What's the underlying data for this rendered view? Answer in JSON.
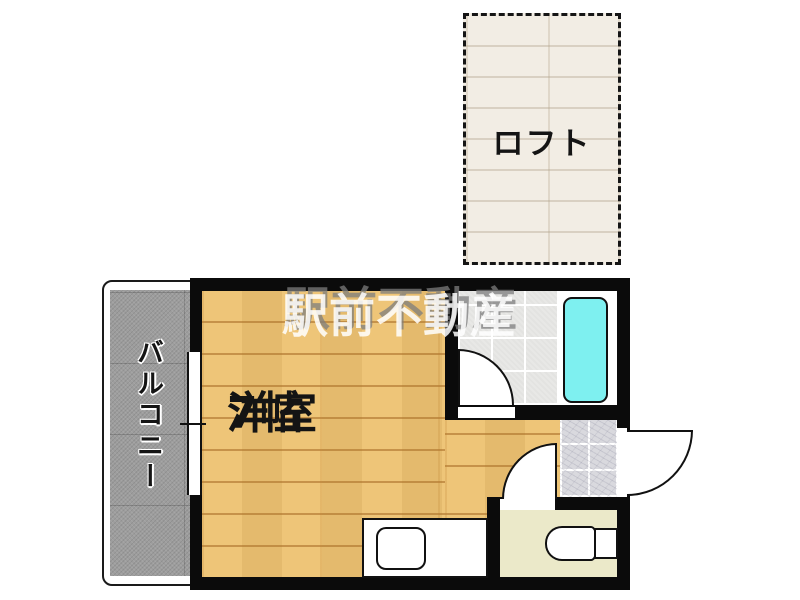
{
  "plan": {
    "watermark": "駅前不動産",
    "rooms": {
      "loft": {
        "label": "ロフト"
      },
      "main": {
        "label": "洋室",
        "size": "7帖"
      },
      "balcony": {
        "label": "バルコニー"
      }
    },
    "fixtures": [
      "bathtub",
      "toilet",
      "kitchen-sink",
      "entrance-door",
      "bathroom-door",
      "room-entrance-door",
      "balcony-window"
    ]
  },
  "colors": {
    "wood": "#edc271",
    "loft": "#f2ede4",
    "balcony": "#9d9d9d",
    "tile": "#e8e8e6",
    "marble": "#d9d9de",
    "toilet": "#ebe9c9",
    "bathtub": "#7ef0f0",
    "wall": "#0b0b0b"
  }
}
